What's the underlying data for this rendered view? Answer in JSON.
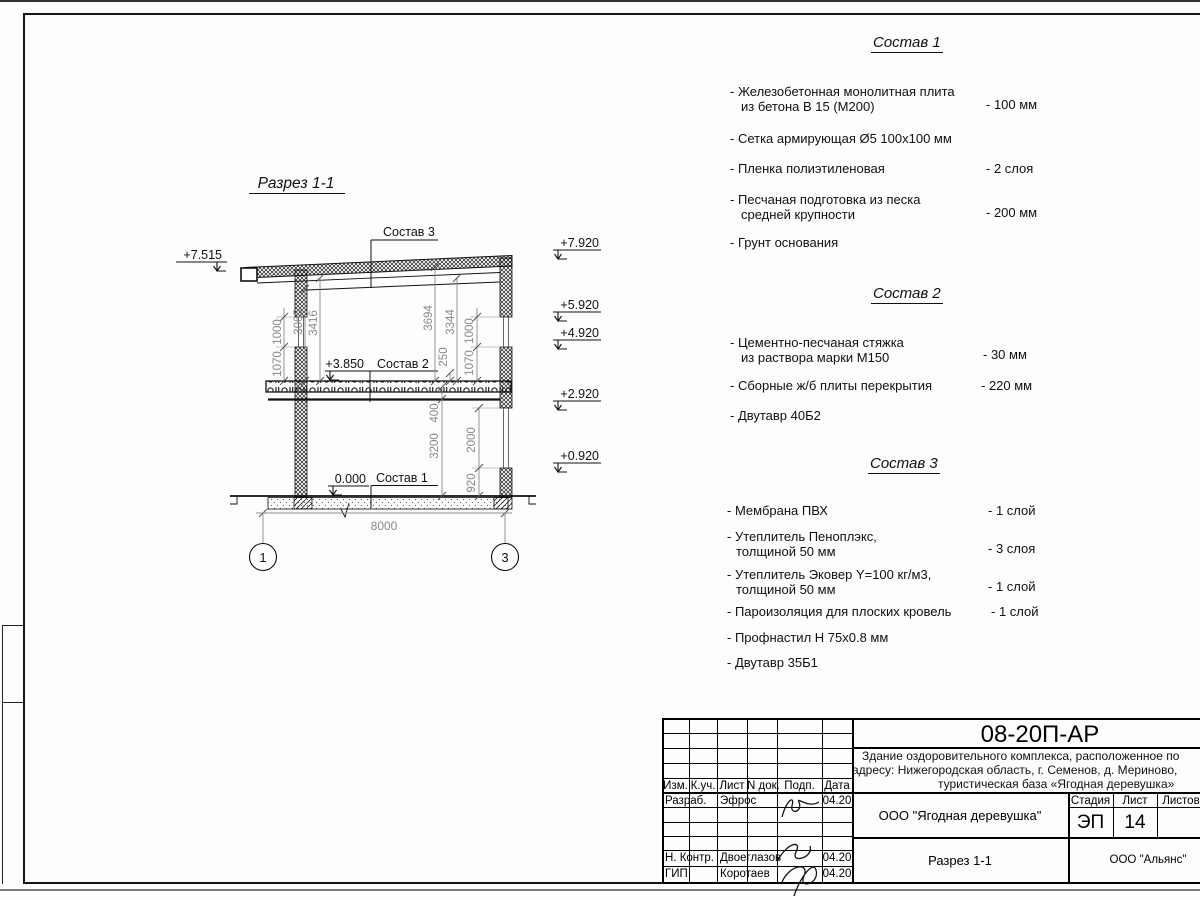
{
  "drawing": {
    "title": "Разрез 1-1",
    "axis_left": "1",
    "axis_right": "3",
    "span_dim": "8000",
    "elev_left": "+7.515",
    "elev_right_1": "+7.920",
    "elev_right_2": "+5.920",
    "elev_right_3": "+4.920",
    "elev_right_4": "+2.920",
    "elev_right_5": "+0.920",
    "mark_slab": "+3.850",
    "mark_floor": "0.000",
    "callout_roof": "Состав 3",
    "callout_slab": "Состав 2",
    "callout_floor": "Состав 1",
    "dims": {
      "l1000": "1000",
      "l1070": "1070",
      "l3065": "3065",
      "l3416": "3416",
      "r3694": "3694",
      "r3344": "3344",
      "r250": "250",
      "r1000": "1000",
      "r1070": "1070",
      "b400": "400",
      "b3200": "3200",
      "b2000": "2000",
      "b920": "920"
    }
  },
  "lists": [
    {
      "title": "Состав 1",
      "items": [
        {
          "l1": "- Железобетонная  монолитная плита",
          "l2": "из бетона В 15 (М200)",
          "val": "- 100 мм"
        },
        {
          "l1": "- Сетка армирующая Ø5 100х100 мм",
          "l2": "",
          "val": ""
        },
        {
          "l1": "- Пленка полиэтиленовая",
          "l2": "",
          "val": "-  2 слоя"
        },
        {
          "l1": "- Песчаная подготовка из песка",
          "l2": "средней крупности",
          "val": "- 200 мм"
        },
        {
          "l1": "- Грунт основания",
          "l2": "",
          "val": ""
        }
      ]
    },
    {
      "title": "Состав 2",
      "items": [
        {
          "l1": "- Цементно-песчаная стяжка",
          "l2": "из раствора марки М150",
          "val": "- 30 мм"
        },
        {
          "l1": "- Сборные ж/б плиты перекрытия",
          "l2": "",
          "val": "- 220 мм"
        },
        {
          "l1": "- Двутавр 40Б2",
          "l2": "",
          "val": ""
        }
      ]
    },
    {
      "title": "Состав 3",
      "items": [
        {
          "l1": "- Мембрана ПВХ",
          "l2": "",
          "val": "- 1 слой"
        },
        {
          "l1": "- Утеплитель Пеноплэкс,",
          "l2": "толщиной 50 мм",
          "val": "- 3 слоя"
        },
        {
          "l1": "- Утеплитель Эковер Y=100 кг/м3,",
          "l2": "толщиной 50 мм",
          "val": "- 1 слой"
        },
        {
          "l1": "- Пароизоляция для плоских кровель",
          "l2": "",
          "val": "- 1 слой"
        },
        {
          "l1": "- Профнастил Н 75х0.8 мм",
          "l2": "",
          "val": ""
        },
        {
          "l1": "- Двутавр 35Б1",
          "l2": "",
          "val": ""
        }
      ]
    }
  ],
  "titleblock": {
    "doc_number": "08-20П-АР",
    "project_line1": "Здание оздоровительного комплекса, расположенное по",
    "project_line2": "адресу: Нижегородская область, г. Семенов, д. Мериново,",
    "project_line3": "туристическая база «Ягодная деревушка»",
    "col_izm": "Изм.",
    "col_kuch": "К.уч.",
    "col_list": "Лист",
    "col_ndok": "N док.",
    "col_podp": "Подп.",
    "col_data": "Дата",
    "row1_role": "Разраб.",
    "row1_name": "Эфрос",
    "row1_date": "04.20",
    "row2_role": "Н. Контр.",
    "row2_name": "Двоеглазов",
    "row2_date": "04.20",
    "row3_role": "ГИП",
    "row3_name": "Коротаев",
    "row3_date": "04.20",
    "stage_label": "Стадия",
    "sheet_label": "Лист",
    "sheets_label": "Листов",
    "stage": "ЭП",
    "sheet_no": "14",
    "org": "ООО \"Ягодная деревушка\"",
    "drawing_name": "Разрез 1-1",
    "company": "ООО \"Альянс\""
  }
}
